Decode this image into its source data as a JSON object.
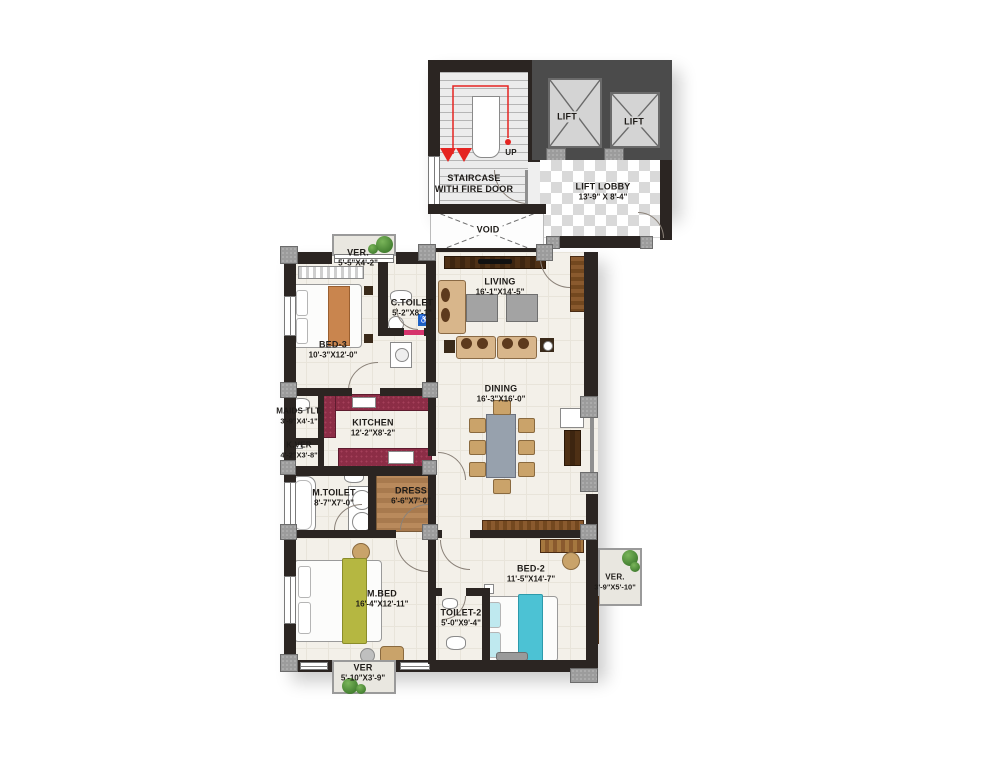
{
  "title": "Apartment Floor Plan",
  "colors": {
    "wall": "#2b2522",
    "column_gray": "#9c9c9c",
    "floor_cream": "#f3f0e9",
    "checker_gray": "#d9d9d9",
    "kitchen_counter_maroon": "#8c2d46",
    "wood_brown": "#8a5a2e",
    "dark_wood": "#4e3015",
    "sofa_tan": "#d8b68b",
    "bed2_accent_cyan": "#4cc2d4",
    "mbed_accent_olive": "#b5b741",
    "stair_guide_red": "#e52421",
    "plant_green": "#4c8a33",
    "accessible_blue": "#1f63c4",
    "door_sill_pink": "#d6336c"
  },
  "labels": {
    "up": "UP"
  },
  "rooms": {
    "staircase": {
      "name": "STAIRCASE",
      "name2": "WITH FIRE DOOR"
    },
    "lift_left": {
      "name": "LIFT"
    },
    "lift_right": {
      "name": "LIFT"
    },
    "lift_lobby": {
      "name": "LIFT LOBBY",
      "dims": "13'-9\" X 8'-4\""
    },
    "void": {
      "name": "VOID"
    },
    "ver_top": {
      "name": "VER.",
      "dims": "5'-5\"X4'-2\""
    },
    "bed3": {
      "name": "BED-3",
      "dims": "10'-3\"X12'-0\""
    },
    "c_toilet": {
      "name": "C.TOILET",
      "dims": "5'-2\"X8'-1\""
    },
    "living": {
      "name": "LIVING",
      "dims": "16'-1\"X14'-5\""
    },
    "dining": {
      "name": "DINING",
      "dims": "16'-3\"X16'-0\""
    },
    "maids_toilet": {
      "name": "MAIDS TLT.",
      "dims": "3'-9\"X4'-1\""
    },
    "kitchen": {
      "name": "KITCHEN",
      "dims": "12'-2\"X8'-2\""
    },
    "k_ver": {
      "name": "K.VER",
      "dims": "4'-2\"X3'-8\""
    },
    "m_toilet": {
      "name": "M.TOILET",
      "dims": "8'-7\"X7'-0\""
    },
    "dress": {
      "name": "DRESS",
      "dims": "6'-6\"X7'-0\""
    },
    "m_bed": {
      "name": "M.BED",
      "dims": "16'-4\"X12'-11\""
    },
    "toilet2": {
      "name": "TOILET-2",
      "dims": "5'-0\"X9'-4\""
    },
    "bed2": {
      "name": "BED-2",
      "dims": "11'-5\"X14'-7\""
    },
    "ver_right": {
      "name": "VER.",
      "dims": "3'-9\"X5'-10\""
    },
    "ver_bottom": {
      "name": "VER",
      "dims": "5'-10\"X3'-9\""
    }
  }
}
